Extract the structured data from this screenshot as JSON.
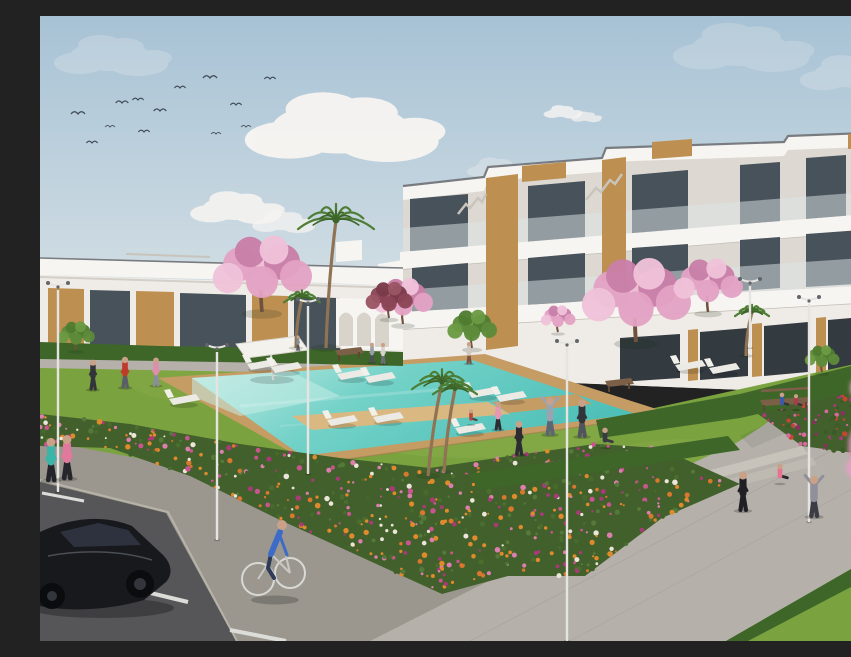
{
  "meta": {
    "title": "Architectural render of a white apartment complex with communal pool, gardens, flower beds, street and people",
    "width": 851,
    "height": 625
  },
  "palette": {
    "skyTop": "#a7c2d5",
    "skyHorizon": "#dde5e8",
    "cloud": "#f8f5f2",
    "wall": "#efece7",
    "wallBright": "#f7f5f1",
    "wallShade": "#ddd9d2",
    "wallDark": "#c2bdb4",
    "roofTrim": "#787c80",
    "glass": "#47525a",
    "glassD": "#333a40",
    "wood": "#bd8f51",
    "woodDark": "#8f6a38",
    "rail": "#dde6e8",
    "lawn": "#7aa23f",
    "lawnLight": "#9cbd57",
    "hedge": "#3e6629",
    "palm": "#4e7d35",
    "palmDark": "#3c6328",
    "trunk": "#8f7354",
    "blossom": "#e3a2c4",
    "blossomLight": "#efc2d8",
    "blossomDeep": "#c97fa8",
    "redTree": "#8a4555",
    "water": "#5ec8c0",
    "waterLight": "#c6ece5",
    "waterDeep": "#4fc0b8",
    "deck": "#c59c64",
    "deckL": "#d9b981",
    "path": "#b5b1aa",
    "pathL": "#c7c3bb",
    "side": "#9b978f",
    "road": "#565659",
    "marking": "#dcdcd8",
    "car": "#17191c",
    "skin": "#c9a188"
  },
  "sky": {
    "birds": [
      [
        38,
        98,
        1
      ],
      [
        52,
        127,
        0.8
      ],
      [
        82,
        87,
        0.9
      ],
      [
        70,
        111,
        0.7
      ],
      [
        98,
        84,
        0.8
      ],
      [
        104,
        116,
        0.8
      ],
      [
        120,
        95,
        0.9
      ],
      [
        140,
        72,
        0.8
      ],
      [
        170,
        62,
        1
      ],
      [
        176,
        118,
        0.7
      ],
      [
        196,
        89,
        0.8
      ],
      [
        206,
        111,
        0.7
      ],
      [
        230,
        63,
        0.8
      ]
    ],
    "clouds": [
      [
        300,
        112,
        1.7,
        0.95
      ],
      [
        195,
        192,
        0.8,
        0.85
      ],
      [
        243,
        206,
        0.55,
        0.7
      ],
      [
        522,
        96,
        0.33,
        0.8
      ],
      [
        546,
        101,
        0.26,
        0.7
      ],
      [
        70,
        40,
        1,
        0.22
      ],
      [
        700,
        32,
        1.2,
        0.2
      ],
      [
        810,
        58,
        0.9,
        0.22
      ],
      [
        455,
        152,
        0.5,
        0.3
      ]
    ]
  },
  "vegetation": {
    "palms": [
      [
        296,
        204,
        38,
        286,
        332
      ],
      [
        262,
        282,
        18,
        256,
        332
      ],
      [
        402,
        366,
        30,
        388,
        460
      ],
      [
        415,
        373,
        22,
        404,
        456
      ],
      [
        712,
        296,
        17,
        706,
        340
      ],
      [
        836,
        300,
        24,
        826,
        368
      ]
    ],
    "blossoms": [
      [
        222,
        296,
        40
      ],
      [
        363,
        308,
        24
      ],
      [
        596,
        326,
        44
      ],
      [
        668,
        296,
        28
      ],
      [
        846,
        296,
        24
      ],
      [
        518,
        316,
        14
      ]
    ],
    "reds": [
      [
        349,
        302,
        19
      ]
    ],
    "greens": [
      [
        432,
        332,
        20
      ],
      [
        36,
        334,
        15
      ],
      [
        782,
        356,
        14
      ]
    ]
  },
  "flowerbeds": [
    {
      "seed": 7,
      "n": 650,
      "pts": [
        [
          0,
          398
        ],
        [
          90,
          408
        ],
        [
          200,
          428
        ],
        [
          300,
          442
        ],
        [
          390,
          452
        ],
        [
          470,
          440
        ],
        [
          555,
          428
        ],
        [
          620,
          432
        ],
        [
          700,
          468
        ],
        [
          622,
          502
        ],
        [
          545,
          560
        ],
        [
          468,
          560
        ],
        [
          402,
          578
        ],
        [
          332,
          546
        ],
        [
          240,
          504
        ],
        [
          150,
          460
        ],
        [
          70,
          432
        ],
        [
          0,
          430
        ]
      ],
      "colors": [
        "#3f6128",
        "#4a6e2e",
        "#55793a",
        "#e08a2e",
        "#d9772f",
        "#dd7fae",
        "#c9558f",
        "#a83a78",
        "#ece5da",
        "#e08a2e",
        "#466a2c"
      ]
    },
    {
      "seed": 3,
      "n": 180,
      "pts": [
        [
          718,
          398
        ],
        [
          851,
          354
        ],
        [
          851,
          442
        ],
        [
          762,
          430
        ]
      ],
      "colors": [
        "#3a5a28",
        "#445f2c",
        "#a83a78",
        "#8a2f5f",
        "#c44632",
        "#d66a9e",
        "#41632a"
      ]
    }
  ],
  "furniture": {
    "loungers": [
      [
        222,
        348
      ],
      [
        246,
        351
      ],
      [
        312,
        358
      ],
      [
        340,
        361
      ],
      [
        650,
        349
      ],
      [
        684,
        352
      ],
      [
        144,
        383
      ],
      [
        302,
        404
      ],
      [
        348,
        401
      ],
      [
        443,
        376
      ],
      [
        471,
        380
      ],
      [
        430,
        412
      ]
    ],
    "benches": [
      [
        308,
        341,
        26
      ],
      [
        578,
        372,
        26
      ],
      [
        744,
        391,
        48
      ]
    ],
    "lamps": [
      [
        18,
        266,
        476
      ],
      [
        177,
        328,
        524
      ],
      [
        268,
        282,
        458
      ],
      [
        527,
        324,
        625
      ],
      [
        710,
        262,
        332
      ],
      [
        769,
        280,
        506
      ],
      [
        846,
        293,
        386
      ]
    ],
    "parasol": {
      "pts": [
        [
          196,
          328
        ],
        [
          258,
          320
        ],
        [
          268,
          334
        ],
        [
          206,
          342
        ]
      ],
      "pole": [
        231,
        338,
        233,
        364
      ]
    }
  },
  "people": [
    [
      11,
      464,
      46,
      "#3ab5a8",
      "#23252b",
      "stand"
    ],
    [
      27,
      462,
      47,
      "#e0799c",
      "#26262c",
      "stand"
    ],
    [
      53,
      373,
      32,
      "#33343a",
      "#33343a",
      "stand"
    ],
    [
      85,
      371,
      33,
      "#c03a2c",
      "#5a5e66",
      "stand"
    ],
    [
      116,
      369,
      30,
      "#e08cab",
      "#8a8e96",
      "stand"
    ],
    [
      332,
      346,
      21,
      "#9a9ea6",
      "#4a4e56",
      "stand"
    ],
    [
      343,
      347,
      22,
      "#d8d4cc",
      "#6a6e76",
      "stand"
    ],
    [
      258,
      334,
      16,
      "#8a8e96",
      "#55585e",
      "stand"
    ],
    [
      429,
      347,
      23,
      "#cfc9c0",
      "#7c5242",
      "stand"
    ],
    [
      458,
      413,
      30,
      "#e598b4",
      "#2c2c32",
      "stand"
    ],
    [
      479,
      438,
      36,
      "#2c2c32",
      "#2c2c32",
      "stand"
    ],
    [
      510,
      418,
      40,
      "#9aa4b0",
      "#5c6672",
      "armsup"
    ],
    [
      542,
      420,
      40,
      "#33343a",
      "#50545c",
      "stand"
    ],
    [
      565,
      431,
      26,
      "#3a3a42",
      "#3a3a42",
      "sit"
    ],
    [
      431,
      408,
      20,
      "#b5493c",
      "#44484e",
      "sit"
    ],
    [
      703,
      494,
      42,
      "#202024",
      "#202024",
      "stand"
    ],
    [
      740,
      467,
      26,
      "#e87390",
      "#26262c",
      "sit"
    ],
    [
      774,
      500,
      44,
      "#90909a",
      "#3c3c44",
      "armsup"
    ],
    [
      742,
      393,
      22,
      "#3a5aa8",
      "#33343a",
      "sit"
    ],
    [
      756,
      393,
      20,
      "#aa3a4c",
      "#33343a",
      "sit"
    ]
  ],
  "foregroundBlossoms": [
    [
      845,
      318,
      22
    ],
    [
      851,
      368,
      28
    ],
    [
      838,
      430,
      30
    ],
    [
      849,
      488,
      26
    ],
    [
      824,
      372,
      14
    ],
    [
      833,
      528,
      20
    ],
    [
      851,
      562,
      24
    ],
    [
      818,
      452,
      12
    ]
  ]
}
